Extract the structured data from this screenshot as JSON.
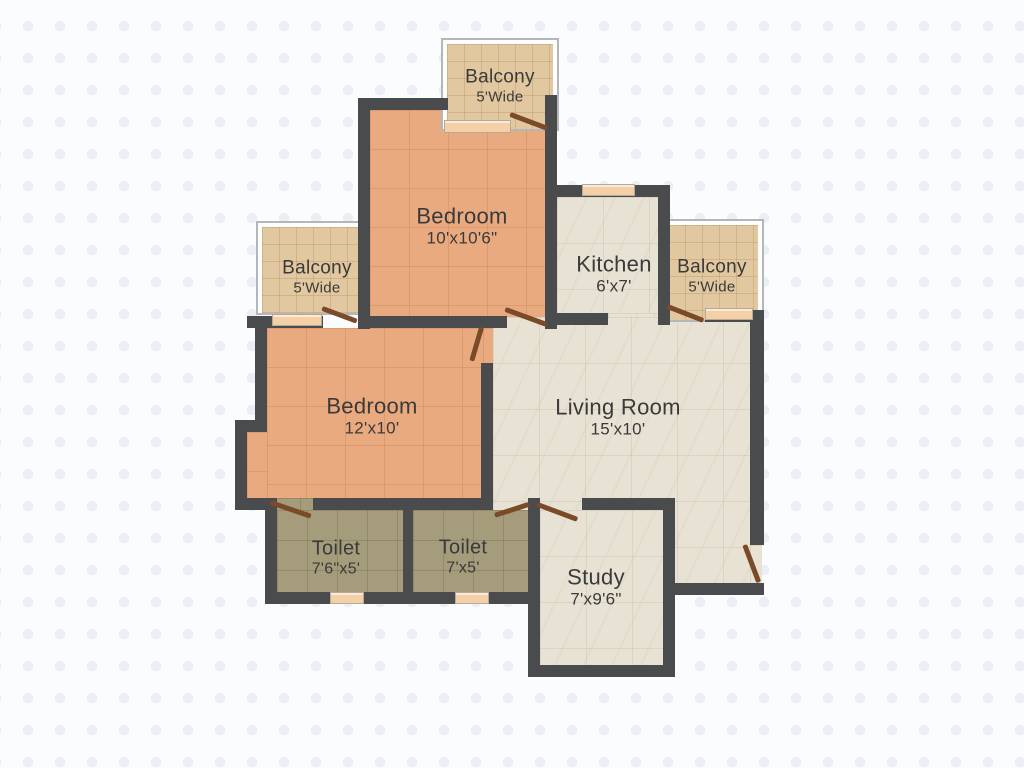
{
  "floorplan": {
    "type": "2BHK apartment floor plan",
    "rooms": [
      {
        "id": "balcony-top",
        "name": "Balcony",
        "dims": "5'Wide"
      },
      {
        "id": "bedroom-1",
        "name": "Bedroom",
        "dims": "10'x10'6\""
      },
      {
        "id": "kitchen",
        "name": "Kitchen",
        "dims": "6'x7'"
      },
      {
        "id": "balcony-left",
        "name": "Balcony",
        "dims": "5'Wide"
      },
      {
        "id": "balcony-right",
        "name": "Balcony",
        "dims": "5'Wide"
      },
      {
        "id": "bedroom-2",
        "name": "Bedroom",
        "dims": "12'x10'"
      },
      {
        "id": "living-room",
        "name": "Living Room",
        "dims": "15'x10'"
      },
      {
        "id": "toilet-1",
        "name": "Toilet",
        "dims": "7'6\"x5'"
      },
      {
        "id": "toilet-2",
        "name": "Toilet",
        "dims": "7'x5'"
      },
      {
        "id": "study",
        "name": "Study",
        "dims": "7'x9'6\""
      }
    ],
    "colors": {
      "wall": "#4a4b4d",
      "bedroom_floor": "#e9aa80",
      "living_kitchen_study_floor": "#e7e2d4",
      "toilet_floor": "#a49c7b",
      "balcony_floor": "#e2c8a0",
      "door": "#7b4a28",
      "window_sill": "#f5cfa6",
      "background": "#fbfcfe",
      "label_text": "#3a3a3a"
    }
  }
}
